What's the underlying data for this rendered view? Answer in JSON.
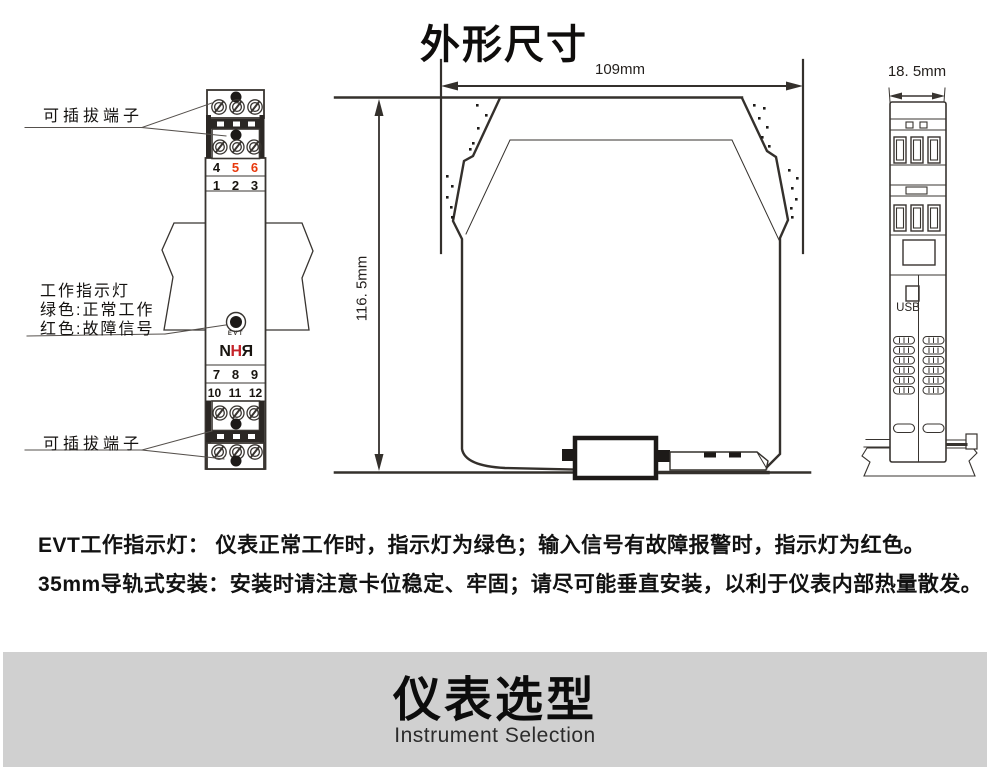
{
  "title": "外形尺寸",
  "front_view": {
    "top_terminal_label": "可插拔端子",
    "bottom_terminal_label": "可插拔端子",
    "indicator_label_lines": [
      "工作指示灯",
      "绿色:正常工作",
      "红色:故障信号"
    ],
    "led_label": "EVT",
    "logo_letters": [
      "N",
      "H",
      "R"
    ],
    "terminal_rows": {
      "row1": [
        "4",
        "5",
        "6"
      ],
      "row2": [
        "1",
        "2",
        "3"
      ],
      "row3": [
        "7",
        "8",
        "9"
      ],
      "row4": [
        "10",
        "11",
        "12"
      ]
    }
  },
  "side_view": {
    "width_label": "109mm",
    "height_label": "116. 5mm"
  },
  "end_view": {
    "width_label": "18. 5mm",
    "usb_label": "USB"
  },
  "notes": [
    "EVT工作指示灯： 仪表正常工作时，指示灯为绿色；输入信号有故障报警时，指示灯为红色。",
    "35mm导轨式安装：安装时请注意卡位稳定、牢固；请尽可能垂直安装，以利于仪表内部热量散发。"
  ],
  "banner": {
    "title": "仪表选型",
    "subtitle": "Instrument Selection"
  },
  "colors": {
    "line": "#383430",
    "red_number": "#e8380c",
    "logo_red": "#c5242a",
    "banner_bg": "#d0d0d0"
  }
}
